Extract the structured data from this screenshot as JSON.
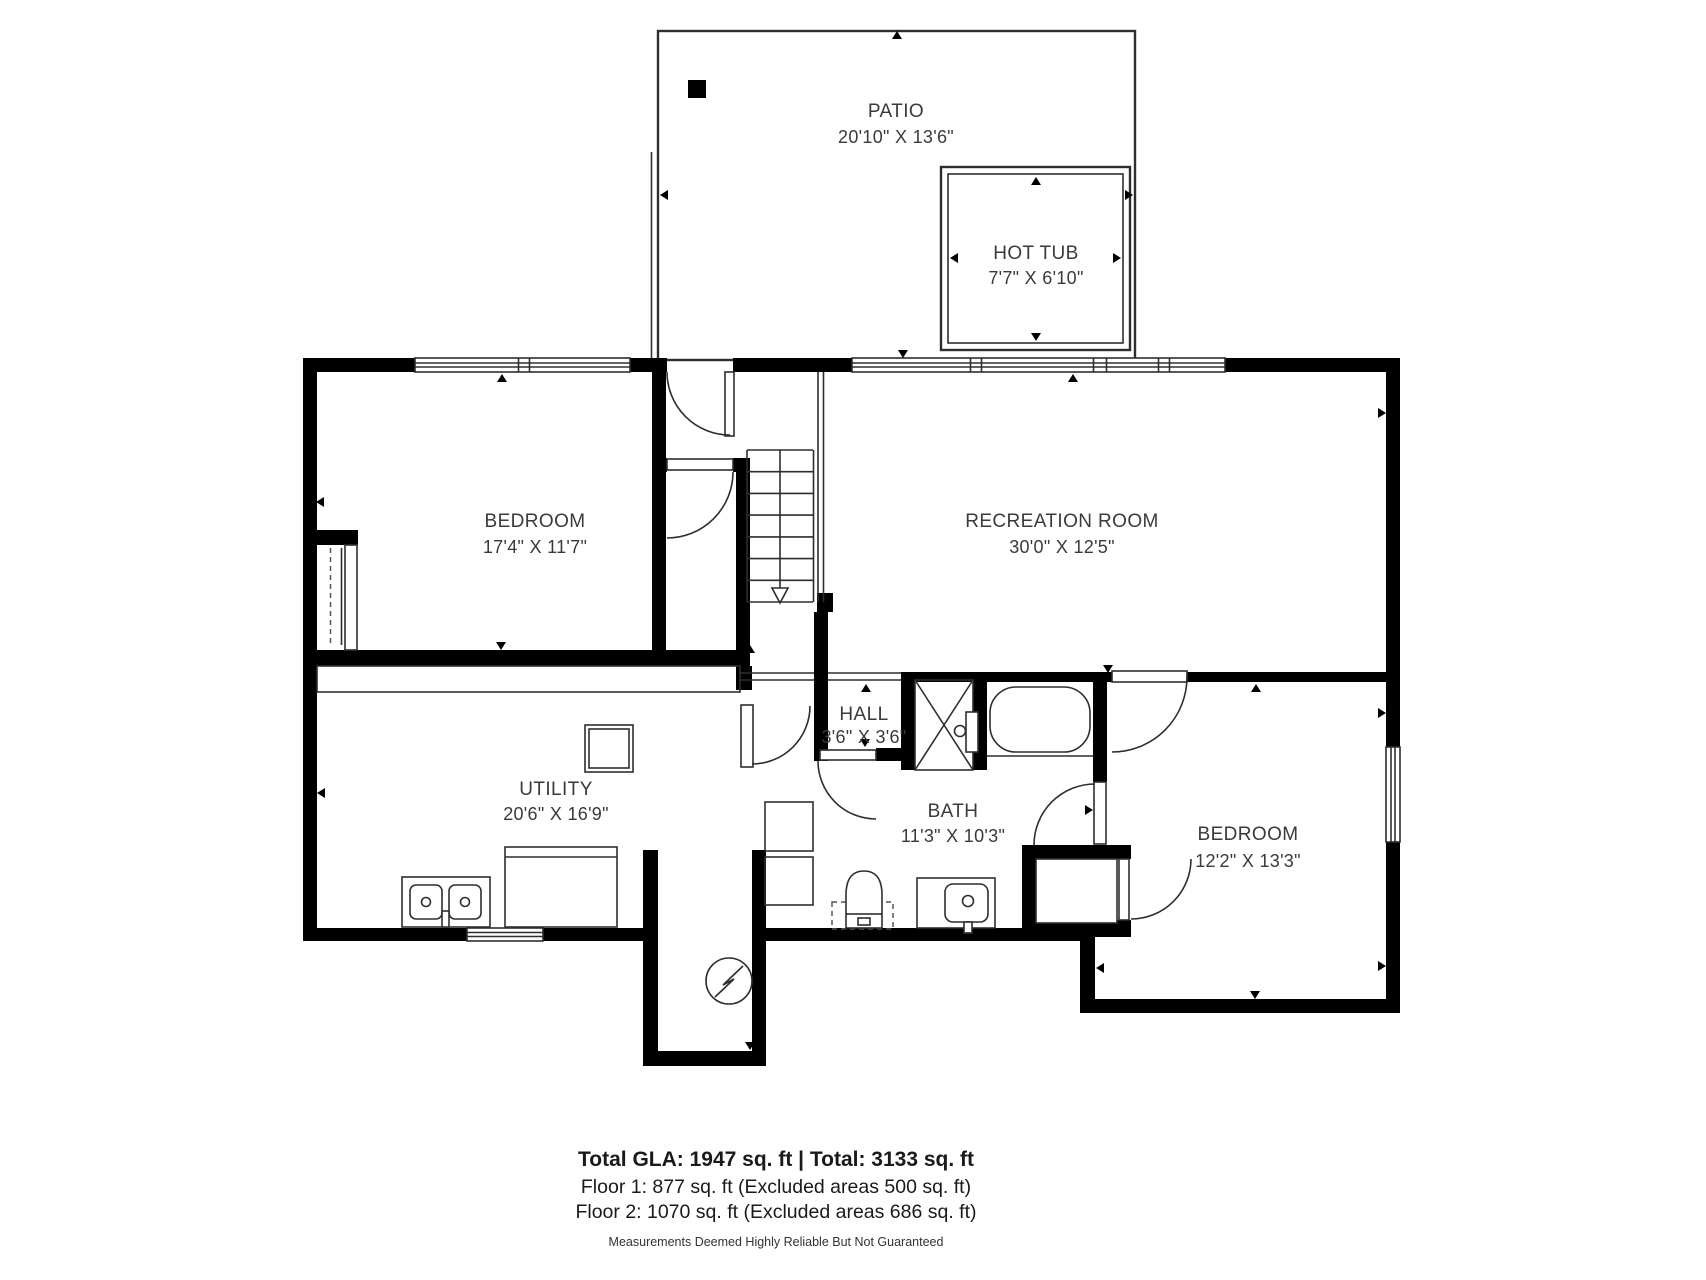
{
  "plan": {
    "rooms": {
      "patio": {
        "name": "PATIO",
        "dims": "20'10\" X 13'6\""
      },
      "hot_tub": {
        "name": "HOT TUB",
        "dims": "7'7\" X 6'10\""
      },
      "bedroom_left": {
        "name": "BEDROOM",
        "dims": "17'4\" X 11'7\""
      },
      "recreation_room": {
        "name": "RECREATION ROOM",
        "dims": "30'0\" X 12'5\""
      },
      "hall": {
        "name": "HALL",
        "dims": "3'6\" X 3'6\""
      },
      "utility": {
        "name": "UTILITY",
        "dims": "20'6\" X 16'9\""
      },
      "bath": {
        "name": "BATH",
        "dims": "11'3\" X 10'3\""
      },
      "bedroom_right": {
        "name": "BEDROOM",
        "dims": "12'2\" X 13'3\""
      }
    },
    "symbols": {
      "electrical_panel": "circle-lightning-icon",
      "stairs_direction": "down-arrow"
    },
    "colors": {
      "walls": "#000000",
      "fixtures": "#2e2e2e",
      "text": "#3a3a3a",
      "background": "#ffffff"
    }
  },
  "footer": {
    "totals": "Total GLA: 1947 sq. ft | Total: 3133 sq. ft",
    "floor1": "Floor 1: 877 sq. ft (Excluded areas 500 sq. ft)",
    "floor2": "Floor 2: 1070 sq. ft (Excluded areas 686 sq. ft)",
    "disclaimer": "Measurements Deemed Highly Reliable But Not Guaranteed"
  }
}
